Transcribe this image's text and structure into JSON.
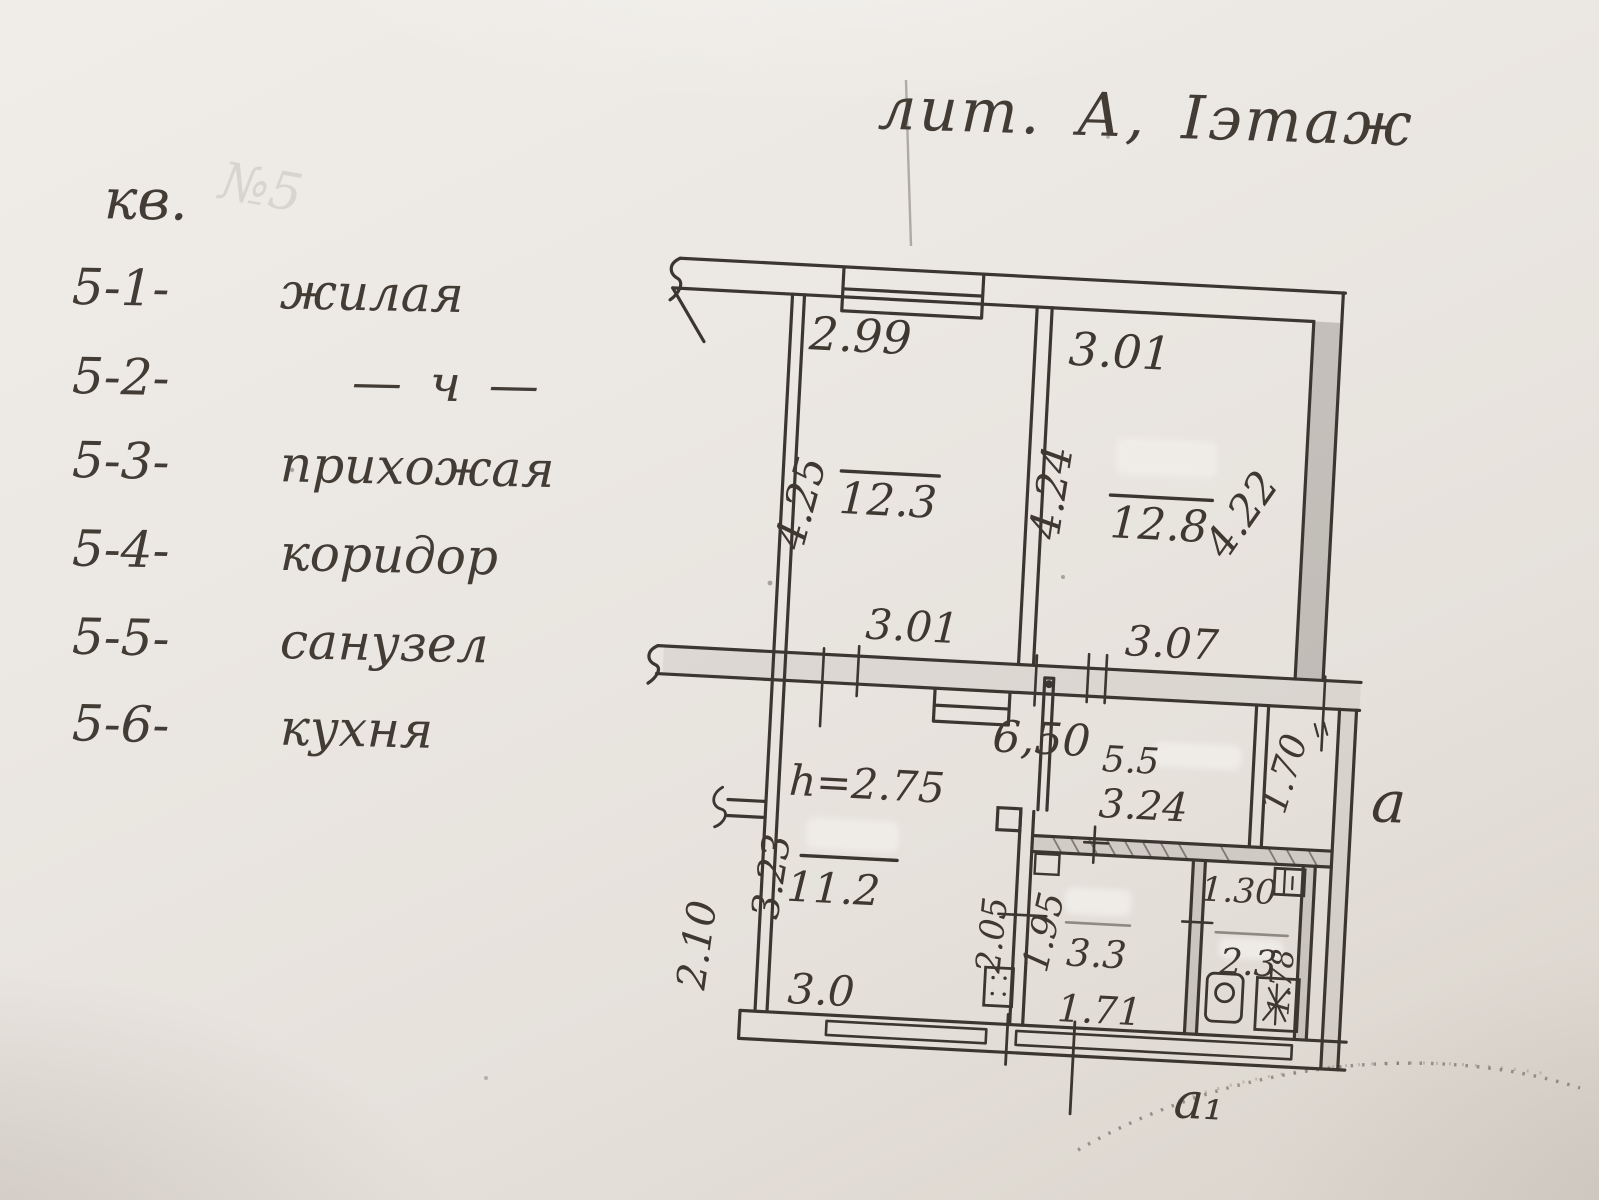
{
  "title": "лит. А, Іэтаж",
  "legend": {
    "heading": "кв.",
    "faint_number": "№5",
    "items": [
      {
        "code": "5-1-",
        "name": "жилая"
      },
      {
        "code": "5-2-",
        "name": "— ч —"
      },
      {
        "code": "5-3-",
        "name": "прихожая"
      },
      {
        "code": "5-4-",
        "name": "коридор"
      },
      {
        "code": "5-5-",
        "name": "санузел"
      },
      {
        "code": "5-6-",
        "name": "кухня"
      }
    ]
  },
  "plan": {
    "ceiling_height": "h=2.75",
    "total_width": "6,50",
    "annex": "a",
    "annex_sub": "a₁",
    "room1": {
      "area": "12.3",
      "top": "2.99",
      "bottom": "3.01",
      "left": "4.25"
    },
    "room2": {
      "area": "12.8",
      "top": "3.01",
      "bottom": "3.07",
      "left": "4.24",
      "right": "4.22"
    },
    "hall": {
      "area": "11.2",
      "bottom": "3.0",
      "left": "3.23",
      "outer_left": "2.10"
    },
    "kitchen": {
      "area": "5.5",
      "width": "3.24",
      "depth": "1.70"
    },
    "bath": {
      "area": "3.3",
      "left": "1.95",
      "outer_left": "2.05",
      "bottom": "1.71"
    },
    "wc": {
      "area": "2.3",
      "top": "1.30",
      "right": "1.78"
    }
  }
}
